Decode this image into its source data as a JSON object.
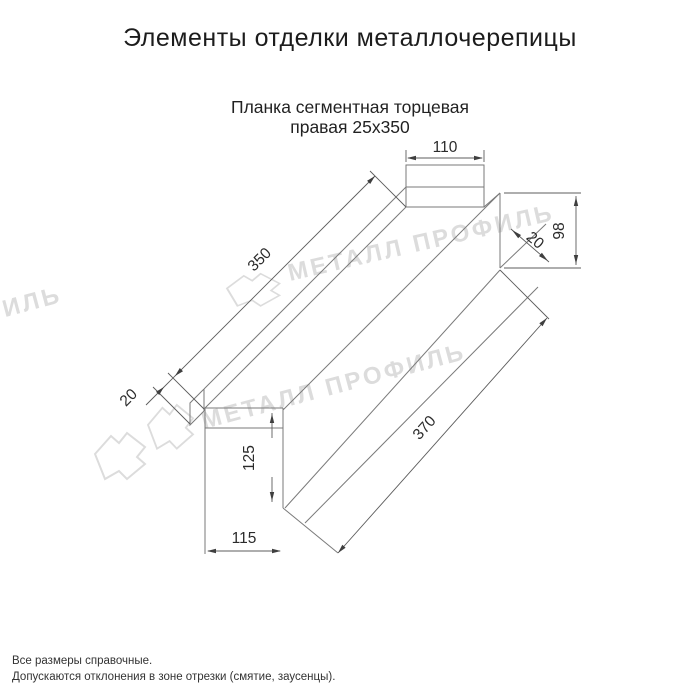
{
  "title": "Элементы отделки металлочерепицы",
  "subtitle": {
    "line1": "Планка сегментная торцевая",
    "line2": "правая 25х350"
  },
  "drawing": {
    "dims": {
      "top_width": "110",
      "length_top": "350",
      "fold_left": "20",
      "fold_right": "20",
      "height_right": "98",
      "height_front": "125",
      "length_bottom": "370",
      "width_bottom": "115"
    }
  },
  "watermark": {
    "text": "МЕТАЛЛ ПРОФИЛЬ",
    "color": "#dcdcdc"
  },
  "footnotes": {
    "line1": "Все размеры справочные.",
    "line2": "Допускаются отклонения в зоне отрезки (смятие, заусенцы)."
  },
  "colors": {
    "outline": "#7a7a7a",
    "dimension_line": "#5c5c5c",
    "text": "#2b2b2b"
  }
}
